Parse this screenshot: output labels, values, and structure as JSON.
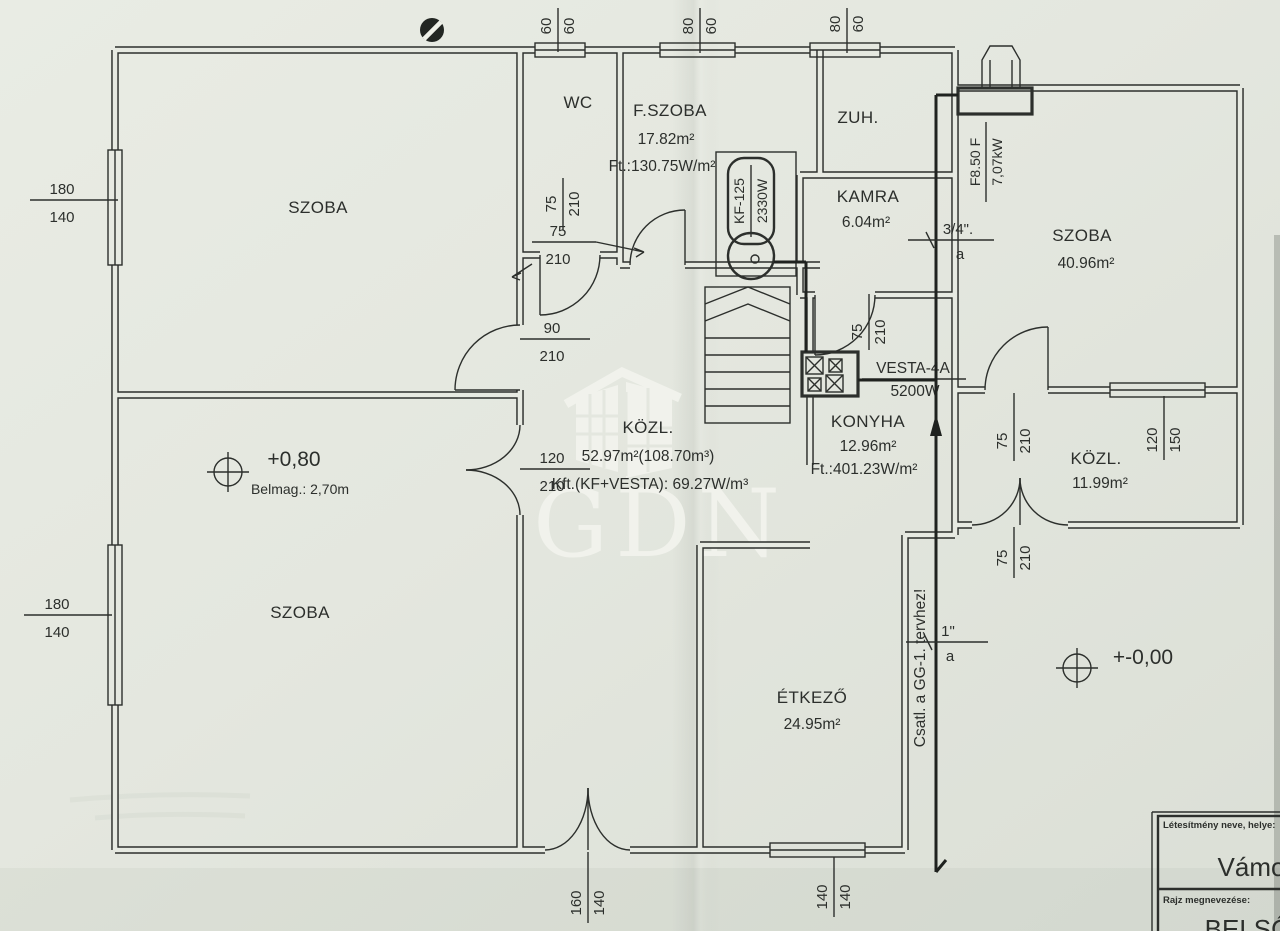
{
  "colors": {
    "paper": "#e4e7df",
    "paper2": "#e7eae2",
    "ink": "#2c2f2c",
    "wm": "#f4f5ef",
    "pipe": "#1f221f"
  },
  "rooms": {
    "szoba_tl": {
      "name": "SZOBA"
    },
    "wc": {
      "name": "WC"
    },
    "fszoba": {
      "name": "F.SZOBA",
      "area": "17.82m²",
      "heat": "Ft.:130.75W/m²"
    },
    "zuh": {
      "name": "ZUH."
    },
    "kamra": {
      "name": "KAMRA",
      "area": "6.04m²"
    },
    "szoba_r": {
      "name": "SZOBA",
      "area": "40.96m²"
    },
    "kozl_c": {
      "name": "KÖZL.",
      "area": "52.97m²(108.70m³)",
      "heat": "Kft.(KF+VESTA): 69.27W/m³"
    },
    "konyha": {
      "name": "KONYHA",
      "area": "12.96m²",
      "heat": "Ft.:401.23W/m²"
    },
    "kozl_r": {
      "name": "KÖZL.",
      "area": "11.99m²"
    },
    "szoba_bl": {
      "name": "SZOBA"
    },
    "etkezo": {
      "name": "ÉTKEZŐ",
      "area": "24.95m²"
    }
  },
  "equipment": {
    "boiler": {
      "model": "KF-125",
      "power": "2330W"
    },
    "stove": {
      "model": "VESTA-4A",
      "power": "5200W"
    },
    "radiator": {
      "model": "F8.50 F",
      "power": "7,07kW"
    }
  },
  "levels": {
    "upper": {
      "value": "+0,80",
      "note": "Belmag.: 2,70m"
    },
    "ground": {
      "value": "+-0,00"
    }
  },
  "pipes": {
    "p34": {
      "size": "3/4\".",
      "line": "a"
    },
    "p1": {
      "size": "1\"",
      "line": "a"
    },
    "note": "Csatl. a GG-1. tervhez!"
  },
  "dims": {
    "d60": {
      "w": "60",
      "h": "60"
    },
    "d8060a": {
      "w": "80",
      "h": "60"
    },
    "d8060b": {
      "w": "80",
      "h": "60"
    },
    "d180a": {
      "w": "180",
      "h": "140"
    },
    "d75a": {
      "w": "75",
      "h": "210"
    },
    "d75b": {
      "w": "75",
      "h": "210"
    },
    "d90": {
      "w": "90",
      "h": "210"
    },
    "d120": {
      "w": "120",
      "h": "210"
    },
    "d180b": {
      "w": "180",
      "h": "140"
    },
    "d75c": {
      "w": "75",
      "h": "210"
    },
    "d75d": {
      "w": "75",
      "h": "210"
    },
    "d12015": {
      "w": "120",
      "h": "150"
    },
    "d75e": {
      "w": "75",
      "h": "210"
    },
    "d160": {
      "w": "160",
      "h": "140"
    },
    "d140": {
      "w": "140",
      "h": "140"
    }
  },
  "watermark": {
    "text": "GDN"
  },
  "titleblock": {
    "field1_label": "Létesítmény neve, helye:",
    "field1_value": "Vámos",
    "field2_label": "Rajz megnevezése:",
    "field2_value": "BELSŐ"
  }
}
